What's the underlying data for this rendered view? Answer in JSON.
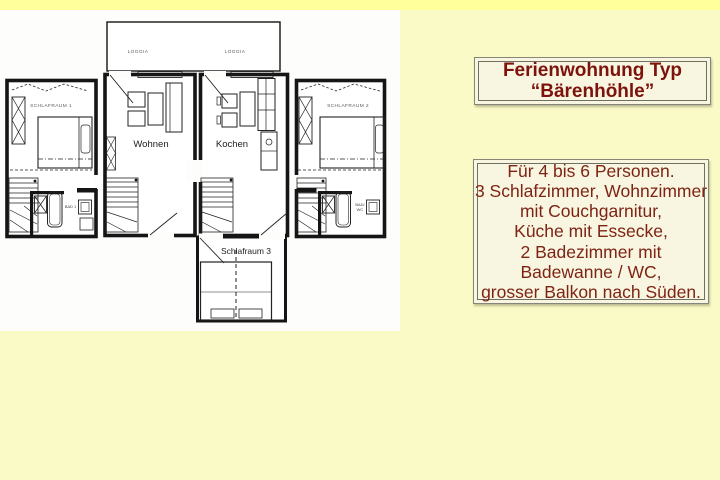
{
  "page": {
    "background_color": "#fafac6",
    "top_strip_color": "#ffff9c",
    "scan_background_color": "#fdfdfb"
  },
  "title_box": {
    "line1": "Ferienwohnung Typ",
    "line2": "“Bärenhöhle”",
    "text_color": "#7d130c",
    "background": "#f8f5e0",
    "border_color": "#6f6f62"
  },
  "info_box": {
    "lines": [
      "Für 4 bis 6 Personen.",
      "3 Schlafzimmer, Wohnzimmer",
      "mit Couchgarnitur,",
      "Küche mit Essecke,",
      "2 Badezimmer mit",
      "Badewanne / WC,",
      "grosser Balkon nach Süden."
    ],
    "text_color": "#7e2415",
    "background": "#f8f5e0",
    "border_color": "#6f6f62"
  },
  "floorplan": {
    "line_color": "#151515",
    "labels": {
      "loggia_left": "LOGGIA",
      "loggia_right": "LOGGIA",
      "bedroom1": "SCHLAFRAUM 1",
      "bedroom2": "SCHLAFRAUM 2",
      "living": "Wohnen",
      "kitchen": "Kochen",
      "bedroom3": "Schlafraum 3",
      "bath1": "BAD 1",
      "bath2_line1": "BAD/",
      "bath2_line2": "WC"
    }
  }
}
